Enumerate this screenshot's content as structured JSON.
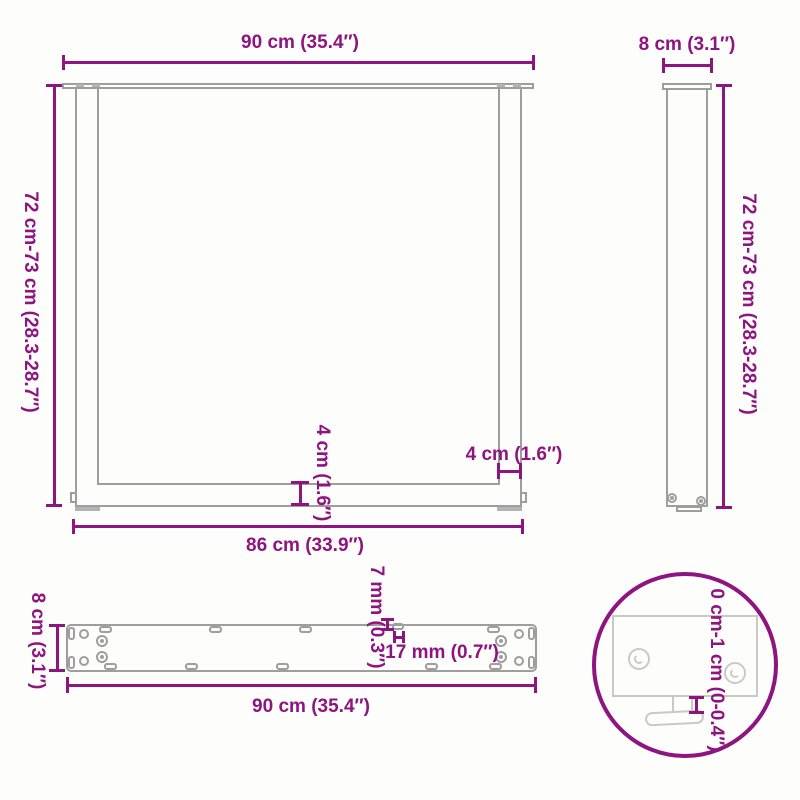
{
  "front_view": {
    "top_width": "90 cm (35.4″)",
    "height_range": "72 cm-73 cm (28.3-28.7″)",
    "crossbar_thickness": "4 cm (1.6″)",
    "post_width": "4 cm (1.6″)",
    "bottom_width": "86 cm (33.9″)"
  },
  "side_view": {
    "depth": "8 cm (3.1″)",
    "height_range": "72 cm-73 cm (28.3-28.7″)"
  },
  "plate_view": {
    "depth": "8 cm (3.1″)",
    "width": "90 cm (35.4″)",
    "hole_diameter": "7 mm (0.3″)",
    "slot_length": "17 mm (0.7″)"
  },
  "foot_detail": {
    "adjustment_range": "0 cm-1 cm (0-0.4″)"
  },
  "colors": {
    "dimension": "#8e147f",
    "drawing_line": "#9e9e9e",
    "detail_line": "#c9c9c9",
    "background": "#fdfdfc"
  }
}
